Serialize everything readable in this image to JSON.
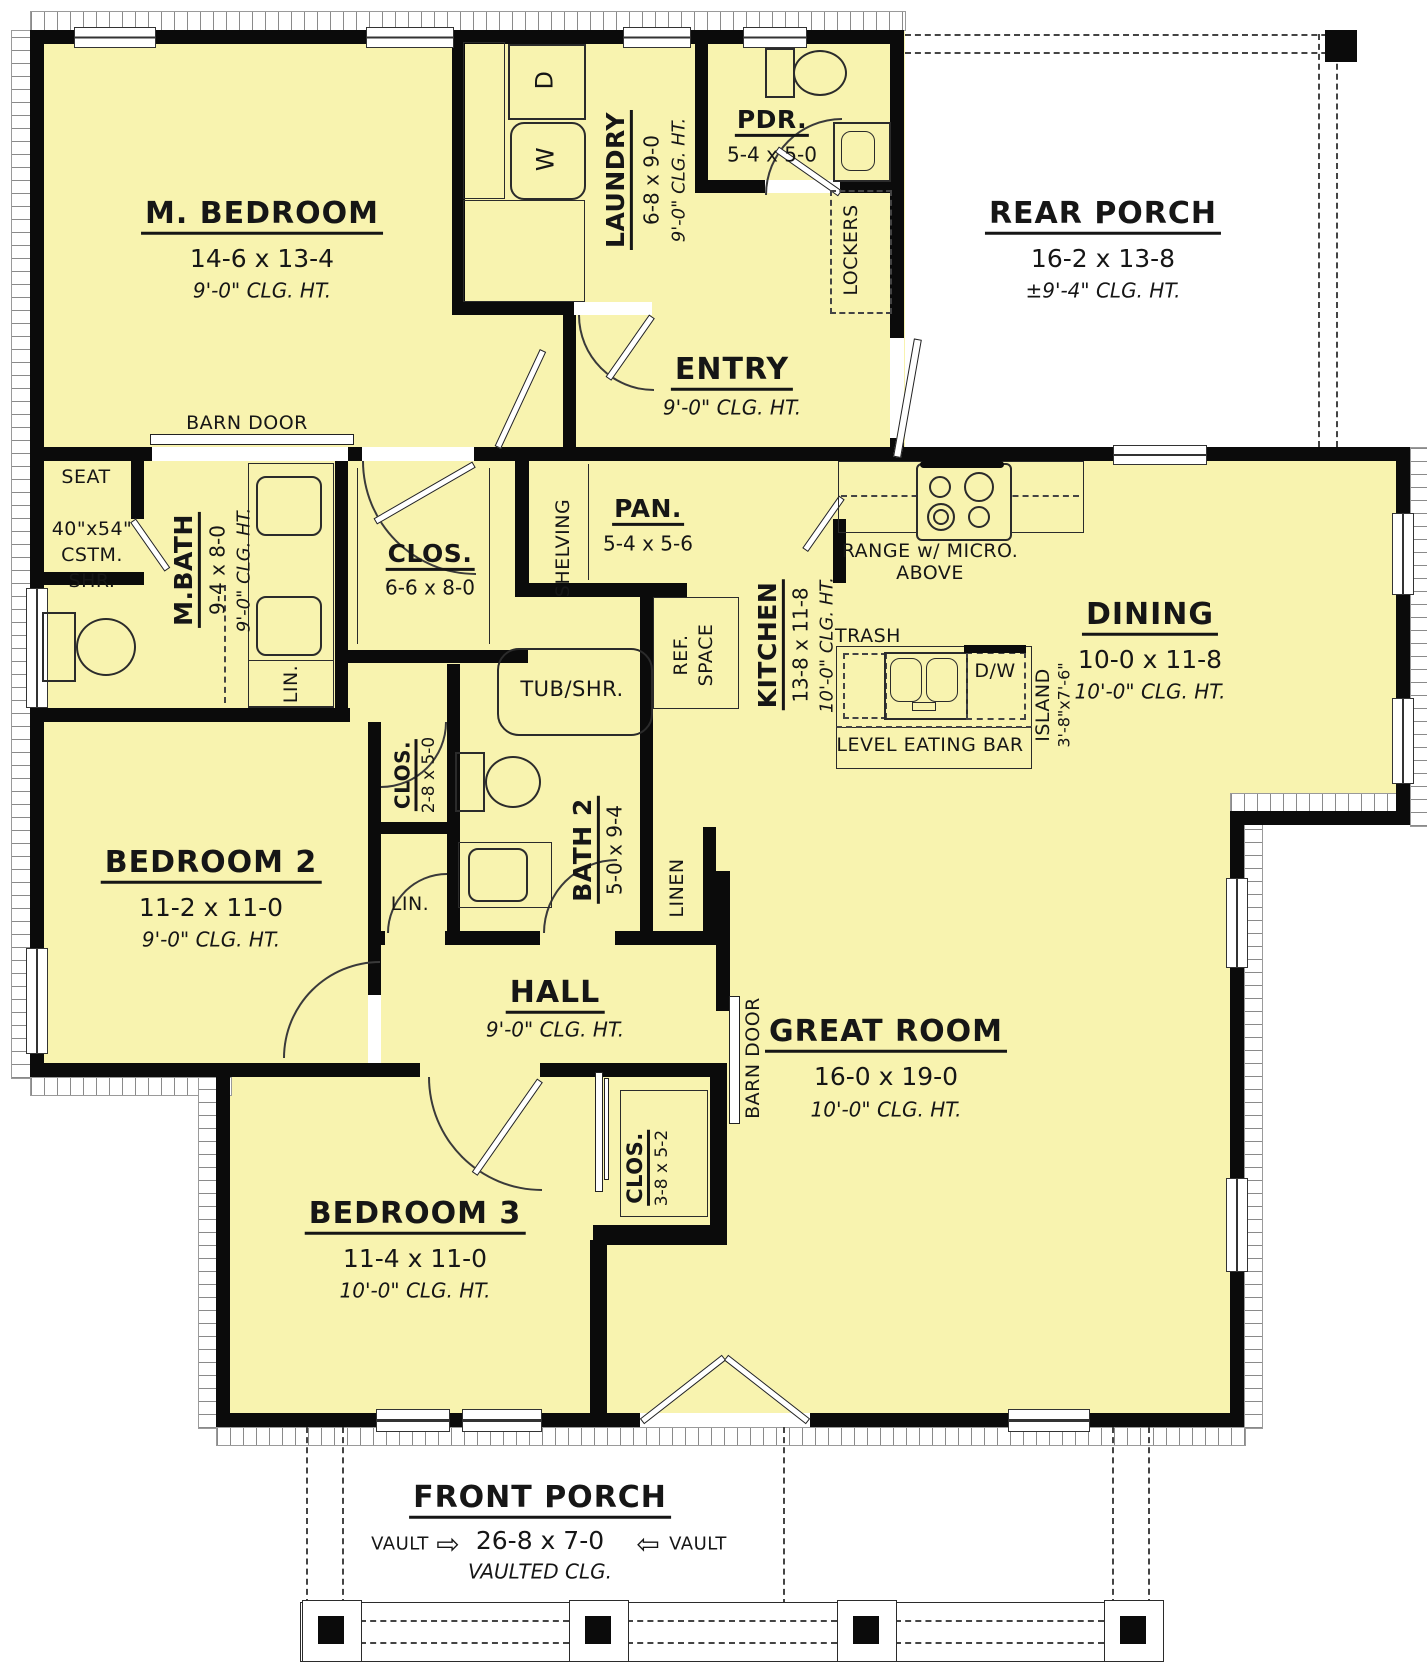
{
  "colors": {
    "floor": "#F8F3AF",
    "wall": "#0B0B0B",
    "porch": "#FFFFFF",
    "line": "#2B2B2B"
  },
  "rooms": {
    "m_bedroom": {
      "name": "M. BEDROOM",
      "dims": "14-6 x 13-4",
      "clg": "9'-0\" CLG. HT."
    },
    "laundry": {
      "name": "LAUNDRY",
      "dims": "6-8 x 9-0",
      "clg": "9'-0\" CLG. HT."
    },
    "pdr": {
      "name": "PDR.",
      "dims": "5-4 x 5-0"
    },
    "rear_porch": {
      "name": "REAR PORCH",
      "dims": "16-2 x 13-8",
      "clg": "±9'-4\" CLG. HT."
    },
    "entry": {
      "name": "ENTRY",
      "clg": "9'-0\" CLG. HT."
    },
    "m_bath": {
      "name": "M.BATH",
      "dims": "9-4 x 8-0",
      "clg": "9'-0\" CLG. HT."
    },
    "m_clos": {
      "name": "CLOS.",
      "dims": "6-6 x 8-0"
    },
    "pan": {
      "name": "PAN.",
      "dims": "5-4 x 5-6"
    },
    "kitchen": {
      "name": "KITCHEN",
      "dims": "13-8 x 11-8",
      "clg": "10'-0\" CLG. HT."
    },
    "dining": {
      "name": "DINING",
      "dims": "10-0 x 11-8",
      "clg": "10'-0\" CLG. HT."
    },
    "bedroom2": {
      "name": "BEDROOM 2",
      "dims": "11-2 x 11-0",
      "clg": "9'-0\" CLG. HT."
    },
    "clos2": {
      "name": "CLOS.",
      "dims": "2-8 x 5-0"
    },
    "bath2": {
      "name": "BATH 2",
      "dims": "5-0 x 9-4"
    },
    "hall": {
      "name": "HALL",
      "clg": "9'-0\" CLG. HT."
    },
    "great_room": {
      "name": "GREAT ROOM",
      "dims": "16-0 x 19-0",
      "clg": "10'-0\" CLG. HT."
    },
    "bedroom3": {
      "name": "BEDROOM 3",
      "dims": "11-4 x 11-0",
      "clg": "10'-0\" CLG. HT."
    },
    "clos3": {
      "name": "CLOS.",
      "dims": "3-8 x 5-2"
    },
    "front_porch": {
      "name": "FRONT PORCH",
      "dims": "26-8 x 7-0",
      "clg": "VAULTED CLG."
    }
  },
  "annotations": {
    "barn_door_top": "BARN DOOR",
    "barn_door_hall": "BARN DOOR",
    "seat": "SEAT",
    "shr_size": "40\"x54\"",
    "shr_cstm": "CSTM.",
    "shr_shr": "SHR.",
    "lin_mbath": "LIN.",
    "lin_hall": "LIN.",
    "linen": "LINEN",
    "lockers": "LOCKERS",
    "shelving": "SHELVING",
    "ref_line1": "REF.",
    "ref_line2": "SPACE",
    "tub": "TUB/SHR.",
    "range_line1": "RANGE w/ MICRO.",
    "range_line2": "ABOVE",
    "trash": "TRASH",
    "dw": "D/W",
    "island": "ISLAND",
    "island_dims": "3'-8\"x7'-6\"",
    "eating_bar": "LEVEL EATING BAR",
    "vault_left": "VAULT",
    "vault_right": "VAULT",
    "washer": "W",
    "dryer": "D"
  }
}
